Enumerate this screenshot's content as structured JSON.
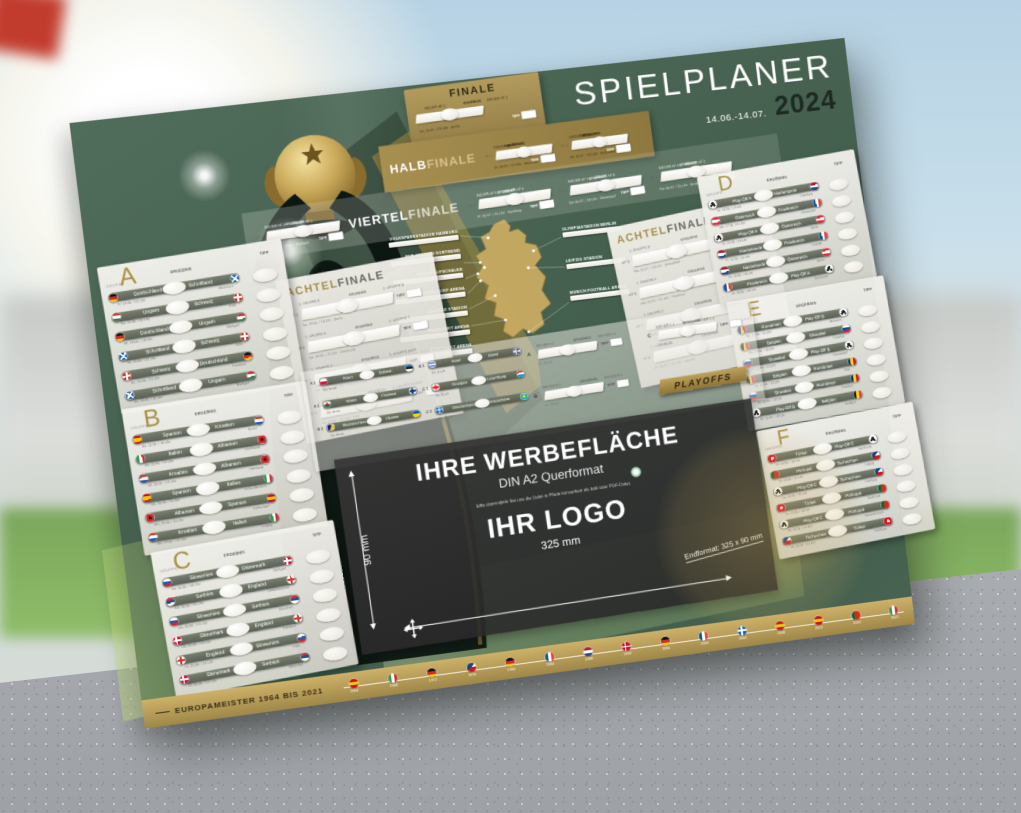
{
  "poster": {
    "title": "SPIELPLANER",
    "date_range": "14.06.-14.07.",
    "year": "2024",
    "colors": {
      "poster_green": "#46614F",
      "gold": "#AC9355",
      "card": "#EFEDE6",
      "ad_panel": "#3A3A3A"
    },
    "labels": {
      "gruppe": "GRUPPE",
      "ergebnis": "ERGEBNIS",
      "tipp": "TIPP"
    },
    "finale": {
      "title": "FINALE",
      "slot1": "SIEGER HF 1",
      "slot2": "SIEGER HF 2",
      "info": "So. 14.07. / 21 Uhr · Berlin"
    },
    "halbfinale": {
      "title_bold": "HALB",
      "title_light": "FINALE",
      "matches": [
        {
          "id": "HF 1",
          "slot1": "SIEGER VF 1",
          "slot2": "SIEGER VF 2",
          "info": "Di. 09.07. / 21 Uhr · München"
        },
        {
          "id": "HF 2",
          "slot1": "SIEGER VF 3",
          "slot2": "SIEGER VF 4",
          "info": "Mi. 10.07. / 21 Uhr · Dortmund"
        }
      ]
    },
    "viertelfinale": {
      "title_bold": "VIERTEL",
      "title_light": "FINALE",
      "matches": [
        {
          "id": "VF 1",
          "slot1": "SIEGER AF 3",
          "slot2": "SIEGER AF 1",
          "info": "Fr. 05.07. / 18 Uhr · Stuttgart"
        },
        {
          "id": "VF 2",
          "slot1": "SIEGER AF 5",
          "slot2": "SIEGER AF 6",
          "info": "Fr. 05.07. / 21 Uhr · Hamburg"
        },
        {
          "id": "VF 3",
          "slot1": "SIEGER AF 7",
          "slot2": "SIEGER AF 8",
          "info": "Sa. 06.07. / 18 Uhr · Düsseldorf"
        },
        {
          "id": "VF 4",
          "slot1": "SIEGER AF 4",
          "slot2": "SIEGER AF 2",
          "info": "Sa. 06.07. / 21 Uhr · Berlin"
        }
      ]
    },
    "achtelfinale": {
      "title_gold": "ACHTEL",
      "title_dark": "FINALE",
      "left": [
        {
          "id": "AF 1",
          "slot1": "2. GRUPPE A",
          "slot2": "2. GRUPPE B",
          "info": "Sa. 29.06. / 18 Uhr · Berlin"
        },
        {
          "id": "AF 2",
          "slot1": "1. GRUPPE A",
          "slot2": "2. GRUPPE C",
          "info": "Sa. 29.06. / 21 Uhr · Dortmund"
        },
        {
          "id": "AF 3",
          "slot1": "1. GRUPPE C",
          "slot2": "3. GRUPPE D/E/F",
          "info": "So. 30.06. / 18 Uhr · Gelsenkirchen"
        },
        {
          "id": "AF 4",
          "slot1": "1. GRUPPE B",
          "slot2": "3. GRUPPE A/D/E/F",
          "info": "So. 30.06. / 21 Uhr · Köln"
        }
      ],
      "right": [
        {
          "id": "AF 5",
          "slot1": "2. GRUPPE D",
          "slot2": "2. GRUPPE E",
          "info": "Mo. 01.07. / 18 Uhr · Düsseldorf"
        },
        {
          "id": "AF 6",
          "slot1": "1. GRUPPE F",
          "slot2": "3. GRUPPE A/B/C",
          "info": "Mo. 01.07. / 21 Uhr · Frankfurt"
        },
        {
          "id": "AF 7",
          "slot1": "1. GRUPPE E",
          "slot2": "3. GRUPPE A/B/C/D",
          "info": "Di. 02.07. / 18 Uhr · München"
        },
        {
          "id": "AF 8",
          "slot1": "1. GRUPPE D",
          "slot2": "2. GRUPPE F",
          "info": "Di. 02.07. / 21 Uhr · Leipzig"
        }
      ]
    },
    "groups": [
      {
        "letter": "A",
        "matches": [
          {
            "home": "Deutschland",
            "away": "Schottland",
            "hf": "de",
            "af": "sct",
            "info": "Fr. 14.06. / 21 Uhr",
            "venue": "München"
          },
          {
            "home": "Ungarn",
            "away": "Schweiz",
            "hf": "hu",
            "af": "ch",
            "info": "Sa. 15.06. / 15 Uhr",
            "venue": "Köln"
          },
          {
            "home": "Deutschland",
            "away": "Ungarn",
            "hf": "de",
            "af": "hu",
            "info": "Mi. 19.06. / 18 Uhr",
            "venue": "Stuttgart"
          },
          {
            "home": "Schottland",
            "away": "Schweiz",
            "hf": "sct",
            "af": "ch",
            "info": "Mi. 19.06. / 21 Uhr",
            "venue": "Köln"
          },
          {
            "home": "Schweiz",
            "away": "Deutschland",
            "hf": "ch",
            "af": "de",
            "info": "So. 23.06. / 21 Uhr",
            "venue": "Frankfurt"
          },
          {
            "home": "Schottland",
            "away": "Ungarn",
            "hf": "sct",
            "af": "hu",
            "info": "So. 23.06. / 21 Uhr",
            "venue": "Stuttgart"
          }
        ]
      },
      {
        "letter": "B",
        "matches": [
          {
            "home": "Spanien",
            "away": "Kroatien",
            "hf": "es",
            "af": "hr",
            "info": "Sa. 15.06. / 18 Uhr",
            "venue": "Berlin"
          },
          {
            "home": "Italien",
            "away": "Albanien",
            "hf": "it",
            "af": "al",
            "info": "Sa. 15.06. / 21 Uhr",
            "venue": "Dortmund"
          },
          {
            "home": "Kroatien",
            "away": "Albanien",
            "hf": "hr",
            "af": "al",
            "info": "Mi. 19.06. / 15 Uhr",
            "venue": "Hamburg"
          },
          {
            "home": "Spanien",
            "away": "Italien",
            "hf": "es",
            "af": "it",
            "info": "Do. 20.06. / 21 Uhr",
            "venue": "Gelsenkirchen"
          },
          {
            "home": "Albanien",
            "away": "Spanien",
            "hf": "al",
            "af": "es",
            "info": "Mo. 24.06. / 21 Uhr",
            "venue": "Düsseldorf"
          },
          {
            "home": "Kroatien",
            "away": "Italien",
            "hf": "hr",
            "af": "it",
            "info": "Mo. 24.06. / 21 Uhr",
            "venue": "Leipzig"
          }
        ]
      },
      {
        "letter": "C",
        "matches": [
          {
            "home": "Slowenien",
            "away": "Dänemark",
            "hf": "si",
            "af": "dk",
            "info": "So. 16.06. / 18 Uhr",
            "venue": "Stuttgart"
          },
          {
            "home": "Serbien",
            "away": "England",
            "hf": "rs",
            "af": "en",
            "info": "So. 16.06. / 21 Uhr",
            "venue": "Gelsenkirchen"
          },
          {
            "home": "Slowenien",
            "away": "Serbien",
            "hf": "si",
            "af": "rs",
            "info": "Do. 20.06. / 15 Uhr",
            "venue": "München"
          },
          {
            "home": "Dänemark",
            "away": "England",
            "hf": "dk",
            "af": "en",
            "info": "Do. 20.06. / 18 Uhr",
            "venue": "Frankfurt"
          },
          {
            "home": "England",
            "away": "Slowenien",
            "hf": "en",
            "af": "si",
            "info": "Di. 25.06. / 21 Uhr",
            "venue": "Köln"
          },
          {
            "home": "Dänemark",
            "away": "Serbien",
            "hf": "dk",
            "af": "rs",
            "info": "Di. 25.06. / 21 Uhr",
            "venue": "München"
          }
        ]
      },
      {
        "letter": "D",
        "matches": [
          {
            "home": "Play-Off A",
            "away": "Niederlande",
            "hf": "po",
            "af": "nl",
            "info": "So. 16.06. / 15 Uhr",
            "venue": "Hamburg"
          },
          {
            "home": "Österreich",
            "away": "Frankreich",
            "hf": "at",
            "af": "fr",
            "info": "Mo. 17.06. / 21 Uhr",
            "venue": "Düsseldorf"
          },
          {
            "home": "Play-Off A",
            "away": "Österreich",
            "hf": "po",
            "af": "at",
            "info": "Fr. 21.06. / 18 Uhr",
            "venue": "Berlin"
          },
          {
            "home": "Niederlande",
            "away": "Frankreich",
            "hf": "nl",
            "af": "fr",
            "info": "Fr. 21.06. / 21 Uhr",
            "venue": "Leipzig"
          },
          {
            "home": "Niederlande",
            "away": "Österreich",
            "hf": "nl",
            "af": "at",
            "info": "Di. 25.06. / 18 Uhr",
            "venue": "Berlin"
          },
          {
            "home": "Frankreich",
            "away": "Play-Off A",
            "hf": "fr",
            "af": "po",
            "info": "Di. 25.06. / 18 Uhr",
            "venue": "Dortmund"
          }
        ]
      },
      {
        "letter": "E",
        "matches": [
          {
            "home": "Rumänien",
            "away": "Play-Off B",
            "hf": "ro",
            "af": "po",
            "info": "Mo. 17.06. / 15 Uhr",
            "venue": "München"
          },
          {
            "home": "Belgien",
            "away": "Slowakei",
            "hf": "be",
            "af": "sk",
            "info": "Mo. 17.06. / 18 Uhr",
            "venue": "Frankfurt"
          },
          {
            "home": "Slowakei",
            "away": "Play-Off B",
            "hf": "sk",
            "af": "po",
            "info": "Fr. 21.06. / 15 Uhr",
            "venue": "Düsseldorf"
          },
          {
            "home": "Belgien",
            "away": "Rumänien",
            "hf": "be",
            "af": "ro",
            "info": "Sa. 22.06. / 21 Uhr",
            "venue": "Köln"
          },
          {
            "home": "Slowakei",
            "away": "Rumänien",
            "hf": "sk",
            "af": "ro",
            "info": "Mi. 26.06. / 18 Uhr",
            "venue": "Frankfurt"
          },
          {
            "home": "Play-Off B",
            "away": "Belgien",
            "hf": "po",
            "af": "be",
            "info": "Mi. 26.06. / 18 Uhr",
            "venue": "Stuttgart"
          }
        ]
      },
      {
        "letter": "F",
        "matches": [
          {
            "home": "Türkei",
            "away": "Play-Off C",
            "hf": "tr",
            "af": "po",
            "info": "Di. 18.06. / 18 Uhr",
            "venue": "Dortmund"
          },
          {
            "home": "Portugal",
            "away": "Tschechien",
            "hf": "pt",
            "af": "cz",
            "info": "Di. 18.06. / 21 Uhr",
            "venue": "Leipzig"
          },
          {
            "home": "Play-Off C",
            "away": "Tschechien",
            "hf": "po",
            "af": "cz",
            "info": "Sa. 22.06. / 15 Uhr",
            "venue": "Hamburg"
          },
          {
            "home": "Türkei",
            "away": "Portugal",
            "hf": "tr",
            "af": "pt",
            "info": "Sa. 22.06. / 18 Uhr",
            "venue": "Dortmund"
          },
          {
            "home": "Play-Off C",
            "away": "Portugal",
            "hf": "po",
            "af": "pt",
            "info": "Mi. 26.06. / 21 Uhr",
            "venue": "Gelsenkirchen"
          },
          {
            "home": "Tschechien",
            "away": "Türkei",
            "hf": "cz",
            "af": "tr",
            "info": "Mi. 26.06. / 21 Uhr",
            "venue": "Hamburg"
          }
        ]
      }
    ],
    "playoffs": {
      "banner": "PLAYOFFS",
      "semis": [
        {
          "id": "A 1",
          "home": "Polen",
          "away": "Estland",
          "hf": "pl",
          "af": "ee",
          "info": "Do. 21.03."
        },
        {
          "id": "A 2",
          "home": "Wales",
          "away": "Finnland",
          "hf": "wa",
          "af": "fi",
          "info": "Do. 21.03."
        },
        {
          "id": "B 2",
          "home": "Bosnien-Herz.",
          "away": "Ukraine",
          "hf": "ba",
          "af": "ua",
          "info": "Do. 21.03."
        },
        {
          "id": "B 1",
          "home": "Israel",
          "away": "Island",
          "hf": "il",
          "af": "is",
          "info": "Do. 21.03."
        },
        {
          "id": "C 1",
          "home": "Georgien",
          "away": "Luxemburg",
          "hf": "ge",
          "af": "lu",
          "info": "Do. 21.03."
        },
        {
          "id": "C 2",
          "home": "Griechenland",
          "away": "Kasachstan",
          "hf": "gr",
          "af": "kz",
          "info": "Do. 21.03."
        }
      ],
      "finals": [
        {
          "id": "A",
          "slot1": "SIEGER A 2",
          "slot2": "SIEGER A 1",
          "info": "Di. 26.03."
        },
        {
          "id": "B",
          "slot1": "SIEGER B 2",
          "slot2": "SIEGER B 1",
          "info": "Di. 26.03."
        },
        {
          "id": "C",
          "slot1": "SIEGER C 1",
          "slot2": "SIEGER C 2",
          "info": "Di. 26.03."
        }
      ]
    },
    "stadiums": {
      "left": [
        "VOLKSPARKSTADION HAMBURG",
        "BVB STADION DORTMUND",
        "ARENA AUFSCHALKE",
        "DÜSSELDORF ARENA",
        "COLOGNE STADION",
        "FRANKFURT ARENA",
        "STUTTGART ARENA"
      ],
      "right": [
        "OLYMPIASTADION BERLIN",
        "LEIPZIG STADION",
        "MUNICH FOOTBALL ARENA"
      ]
    },
    "ad": {
      "headline": "IHRE WERBEFLÄCHE",
      "subline": "DIN A2 Querformat",
      "note": "Bitte übermitteln Sie uns die Datei in Pfade konvertiert als Bild oder PDF-Datei.",
      "logo_placeholder": "IHR LOGO",
      "width_label": "325 mm",
      "height_label": "90 mm",
      "endformat": "Endformat: 325 x 90 mm"
    },
    "champions": {
      "label": "EUROPAMEISTER 1964 BIS 2021",
      "entries": [
        {
          "year": "1964",
          "flag": "es"
        },
        {
          "year": "1968",
          "flag": "it"
        },
        {
          "year": "1972",
          "flag": "de"
        },
        {
          "year": "1976",
          "flag": "cs"
        },
        {
          "year": "1980",
          "flag": "de"
        },
        {
          "year": "1984",
          "flag": "fr"
        },
        {
          "year": "1988",
          "flag": "nl"
        },
        {
          "year": "1992",
          "flag": "dk"
        },
        {
          "year": "1996",
          "flag": "de"
        },
        {
          "year": "2000",
          "flag": "fr"
        },
        {
          "year": "2004",
          "flag": "gr"
        },
        {
          "year": "2008",
          "flag": "es"
        },
        {
          "year": "2012",
          "flag": "es"
        },
        {
          "year": "2016",
          "flag": "pt"
        },
        {
          "year": "2021",
          "flag": "it"
        }
      ]
    }
  }
}
